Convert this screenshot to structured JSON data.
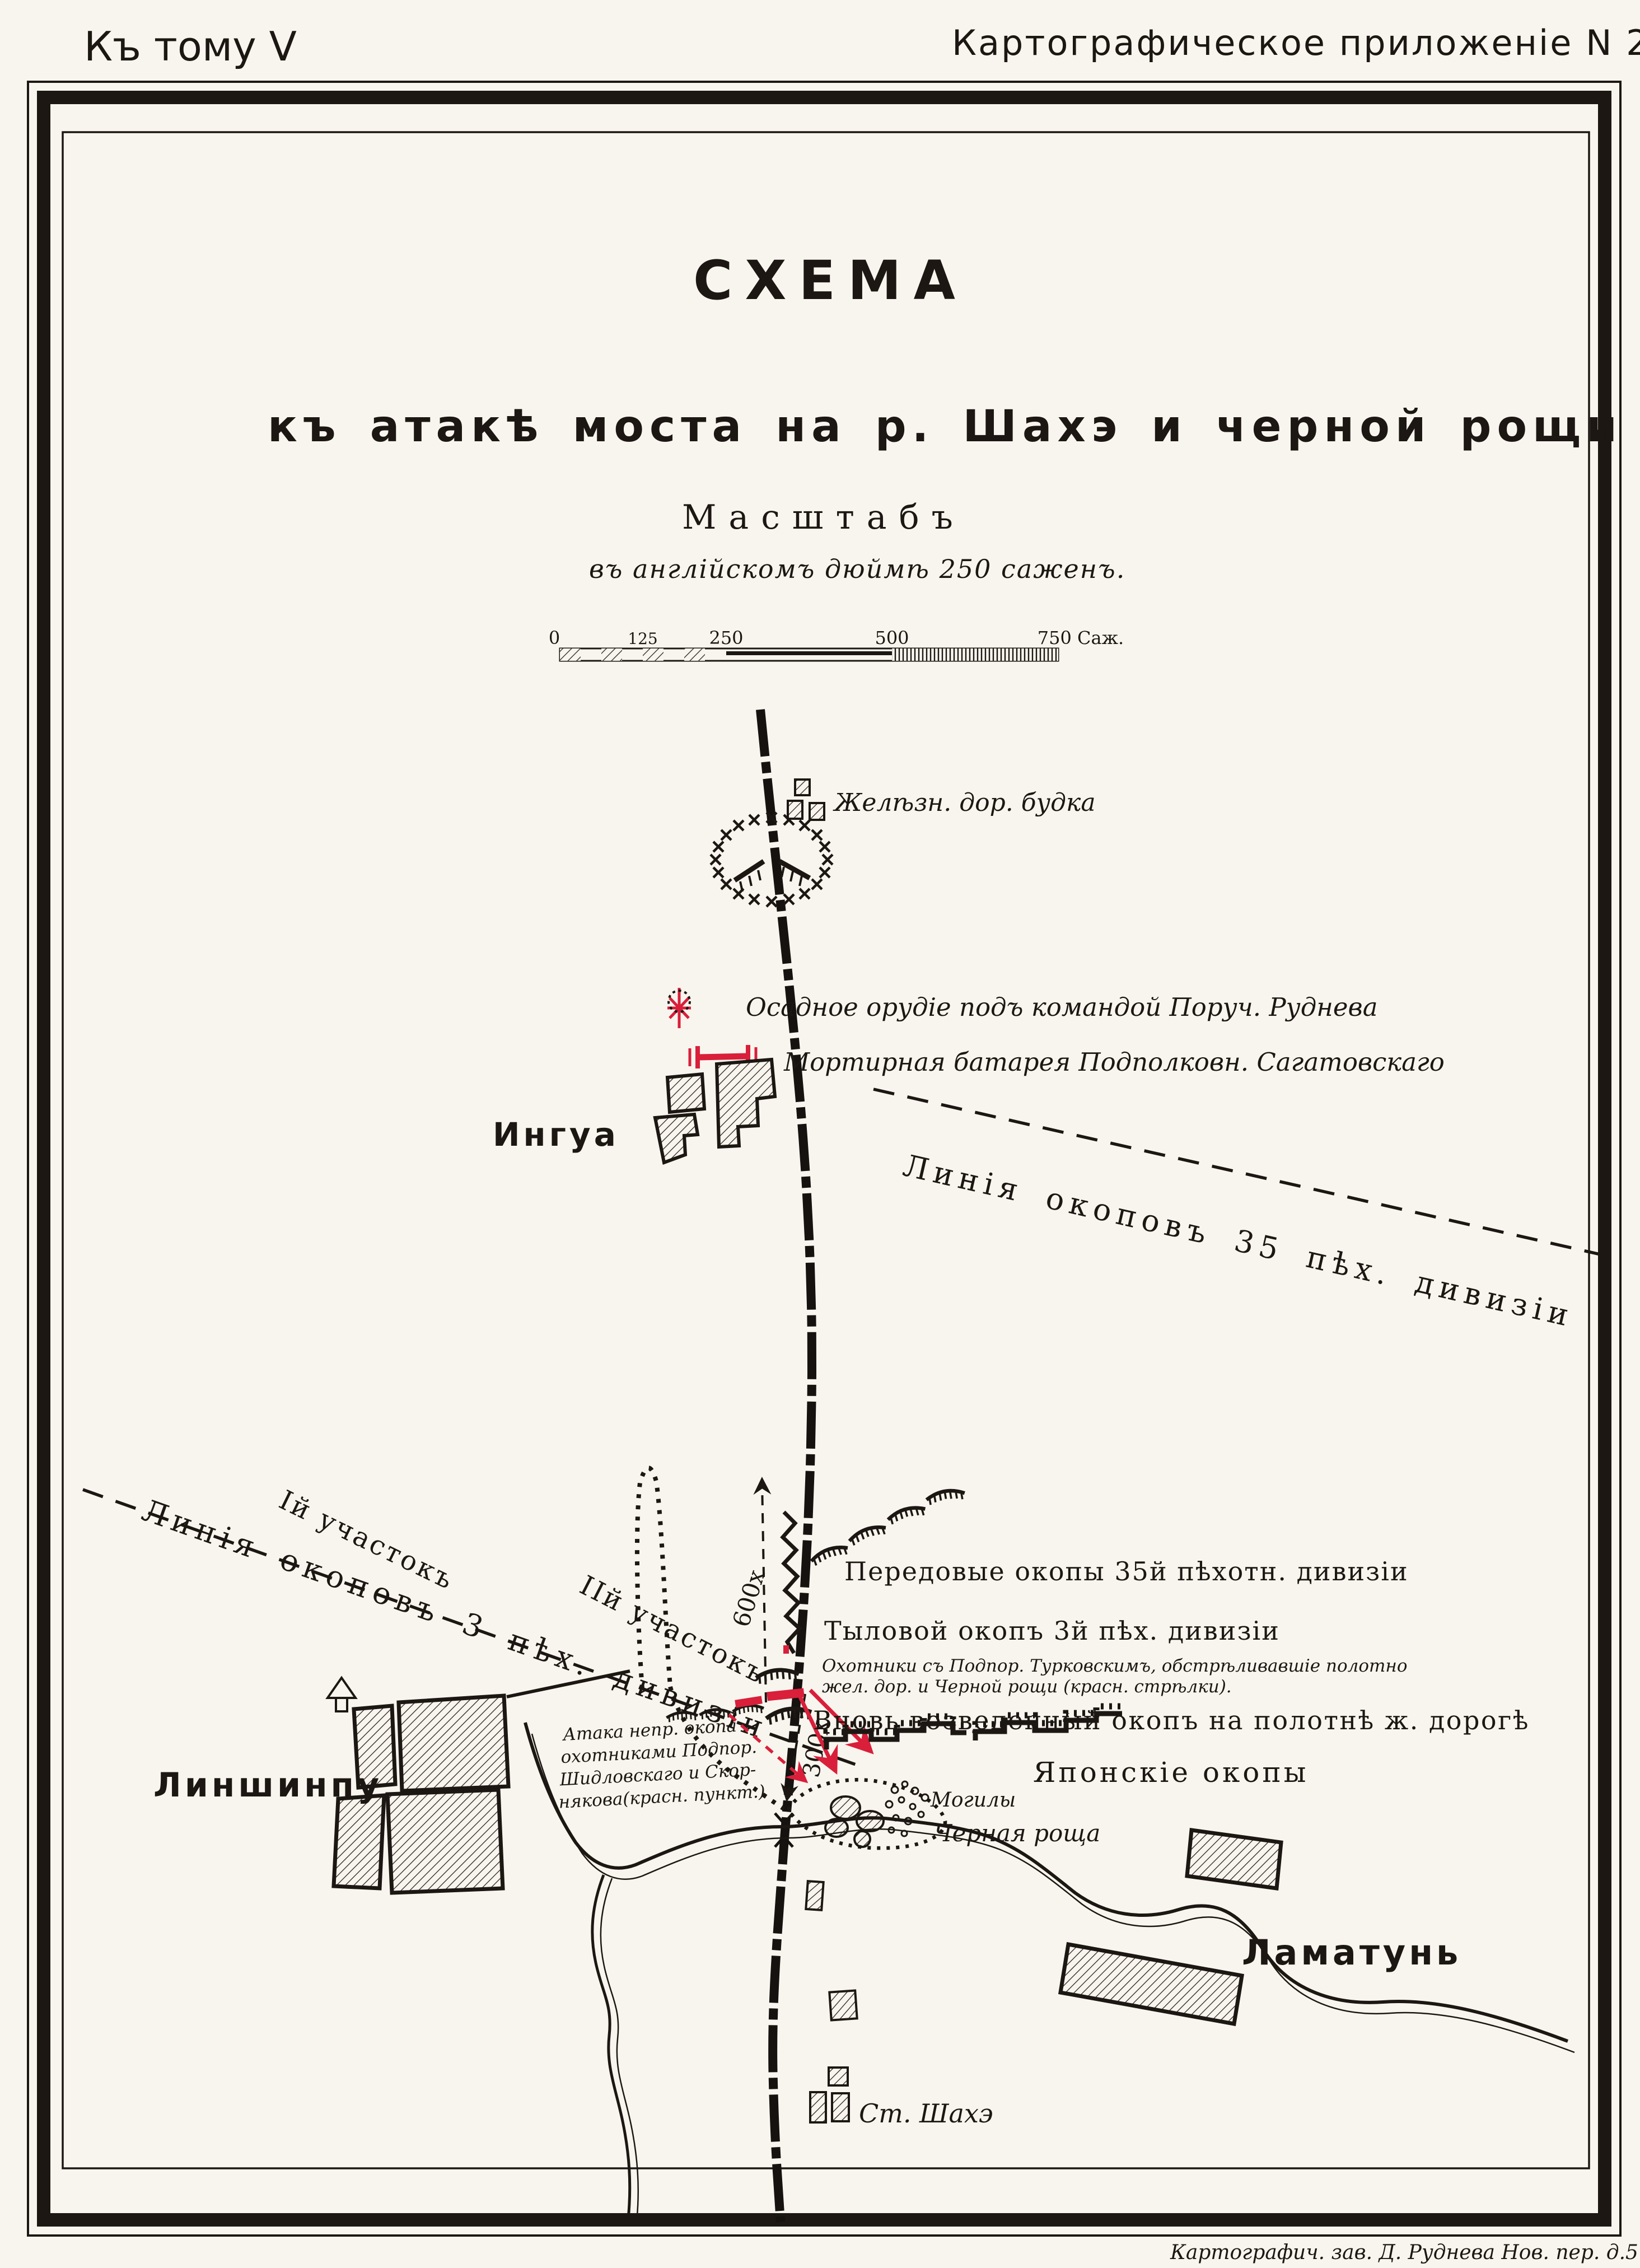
{
  "header": {
    "volume": "Къ тому V",
    "appendix": "Картографическое приложеніе  N 26."
  },
  "title": {
    "main": "СХЕМА",
    "subtitle": "къ атакѣ моста на р. Шахэ и черной рощи"
  },
  "scale": {
    "heading": "Масштабъ",
    "note": "въ англійскомъ дюймѣ 250 саженъ.",
    "ticks": [
      "0",
      "125",
      "250",
      "500"
    ],
    "end_label": "750 Саж."
  },
  "map": {
    "railway_hut": "Желѣзн. дор. будка",
    "siege_gun": "Осадное орудіе подъ командой Поруч. Руднева",
    "mortar_battery": "Мортирная батарея Подполковн. Сагатовскаго",
    "village_ingua": "Ингуа",
    "line_35": "Линія окоповъ 35 пѣх. дивизіи",
    "line_3": "Линія окоповъ 3 пѣх. дивизіи",
    "sector_1": "Iй участокъ",
    "sector_2": "IIй участокъ",
    "dist_600": "600х",
    "dist_300": "300х",
    "forward_trenches": "Передовые окопы 35й пѣхотн. дивизіи",
    "rear_trench": "Тыловой окопъ 3й пѣх. дивизіи",
    "hunters_note_1": "Охотники съ Подпор. Турковскимъ, обстрѣливавшіе полотно",
    "hunters_note_2": "жел. дор. и Черной рощи (красн. стрѣлки).",
    "new_trench": "Вновь возведенный окопъ на полотнѣ ж. дорогѣ",
    "japanese_trenches": "Японскіе окопы",
    "graves": "Могилы",
    "black_grove": "Черная роща",
    "village_linshinpu": "Линшинпу",
    "village_lamatun": "Ламатунь",
    "station": "Ст. Шахэ",
    "attack_note_1": "Атака непр. окопа",
    "attack_note_2": "охотниками Подпор.",
    "attack_note_3": "Шидловскаго и Скор-",
    "attack_note_4": "някова(красн. пункт.)"
  },
  "footer": {
    "imprint": "Картографич. зав. Д. Руднева Нов. пер. д.5 СПБ"
  },
  "colors": {
    "paper": "#f8f5ee",
    "ink": "#1c1712",
    "red": "#d91f3a"
  }
}
